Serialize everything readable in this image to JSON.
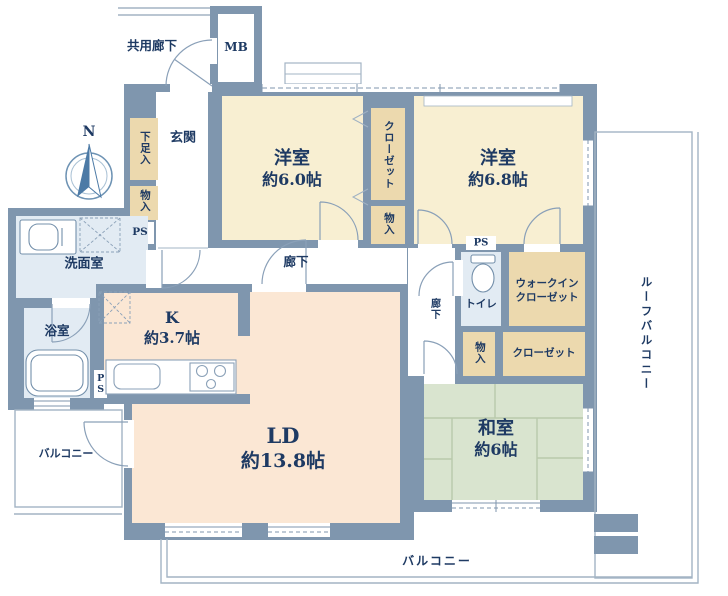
{
  "compass": {
    "north": "N"
  },
  "exterior": {
    "shared_corridor": "共用廊下",
    "meter_box": "MB",
    "balcony_left": "バルコニー",
    "balcony_bottom": "バルコニー",
    "roof_balcony": "ルーフバルコニー"
  },
  "entrance_area": {
    "genkan": "玄関",
    "shoe_cupboard": "下足入",
    "storage": "物入",
    "pipe_space": "PS"
  },
  "wet_area": {
    "washroom": "洗面室",
    "bathroom": "浴室",
    "toilet": "トイレ",
    "pipe_space_mid": "PS",
    "pipe_space_kitchen": "PS"
  },
  "rooms": {
    "western1": {
      "name": "洋室",
      "size": "約6.0帖"
    },
    "western2": {
      "name": "洋室",
      "size": "約6.8帖"
    },
    "kitchen": {
      "name": "K",
      "size": "約3.7帖"
    },
    "living": {
      "name": "LD",
      "size": "約13.8帖"
    },
    "japanese": {
      "name": "和室",
      "size": "約6帖"
    }
  },
  "storage": {
    "closet_mid": "クローゼット",
    "storage_mid": "物入",
    "wic_line1": "ウォークイン",
    "wic_line2": "クローゼット",
    "japanese_storage": "物入",
    "japanese_closet": "クローゼット"
  },
  "corridors": {
    "hallway": "廊下",
    "hallway_small": "廊下"
  },
  "colors": {
    "wall": "#7f96ae",
    "western_room": "#f8efd2",
    "closet": "#ecd9ae",
    "living_kitchen": "#fbe7d4",
    "japanese_room": "#d9e4cf",
    "wet_area": "#e2ebf3",
    "text": "#1e3a63",
    "thin_outline": "#a3b4c4"
  }
}
